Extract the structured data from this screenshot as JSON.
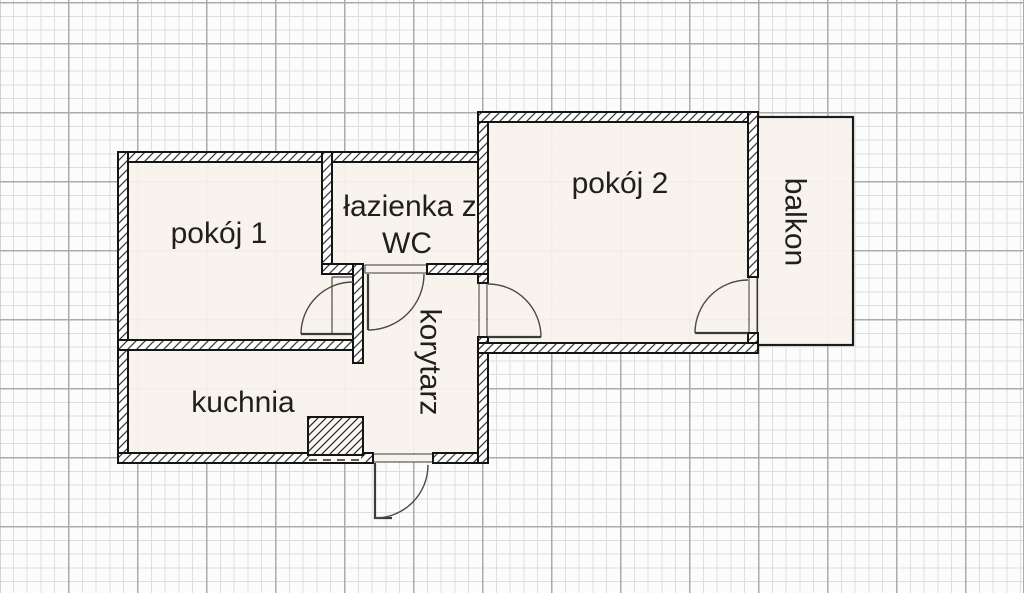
{
  "diagram": {
    "type": "apartment-floor-plan",
    "rooms": [
      {
        "name": "pokoj-1",
        "label": "pokój 1",
        "orientation": "horizontal"
      },
      {
        "name": "lazienka-wc",
        "label": "łazienka z",
        "label_line2": "WC",
        "orientation": "horizontal"
      },
      {
        "name": "pokoj-2",
        "label": "pokój 2",
        "orientation": "horizontal"
      },
      {
        "name": "balkon",
        "label": "balkon",
        "orientation": "vertical"
      },
      {
        "name": "kuchnia",
        "label": "kuchnia",
        "orientation": "horizontal"
      },
      {
        "name": "korytarz",
        "label": "korytarz",
        "orientation": "vertical"
      }
    ],
    "colors": {
      "background": "#fcfcfc",
      "grid_minor": "#dedede",
      "grid_major": "#ababab",
      "room_fill": "#f8f2ec",
      "wall_outline": "#141414",
      "label_text": "#1f1f1f"
    }
  }
}
